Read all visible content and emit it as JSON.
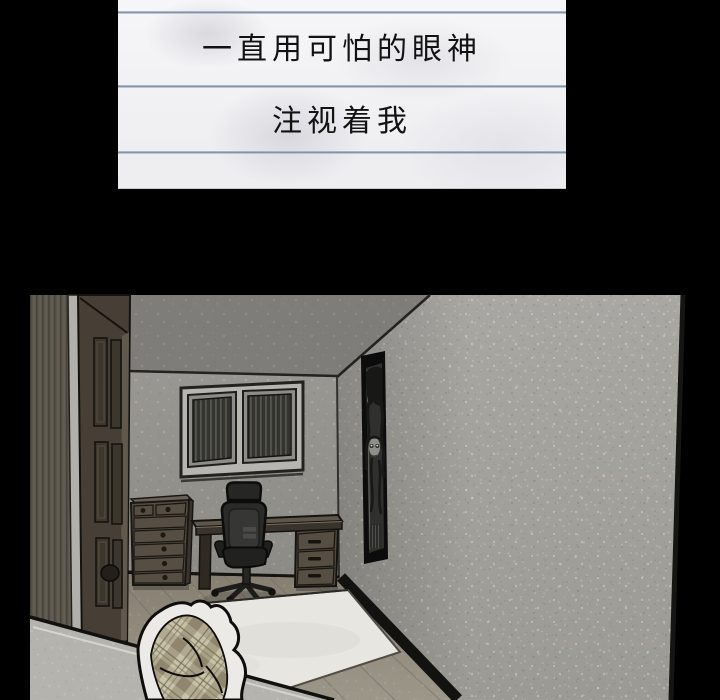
{
  "caption": {
    "lines": [
      "一直用可怕的眼神",
      "注视着我"
    ]
  },
  "scene": {
    "type": "comic-panel-illustration",
    "setting": "dim corner view of a bedroom",
    "objects": [
      "open-paneled-door",
      "window-with-dark-blinds",
      "tall-framed-poster-with-eerie-figure",
      "chest-of-drawers",
      "desk-with-drawer-pedestal",
      "black-office-chair",
      "white-area-rug",
      "plaid-blanket",
      "wood-plank-floor",
      "textured-gray-walls"
    ],
    "palette": {
      "background": "#000000",
      "paper": "#f4f4f6",
      "rule_line": "#64758b",
      "ink": "#121212",
      "ceiling": "#7e7d79",
      "back_wall": "#93928d",
      "right_wall": "#a4a39e",
      "door": "#473f35",
      "floor": "#948e81",
      "rug": "#e7e6e1",
      "chair": "#212121",
      "wood_furniture": "#544c41",
      "blanket_plaid": "#c7c1a8"
    }
  }
}
